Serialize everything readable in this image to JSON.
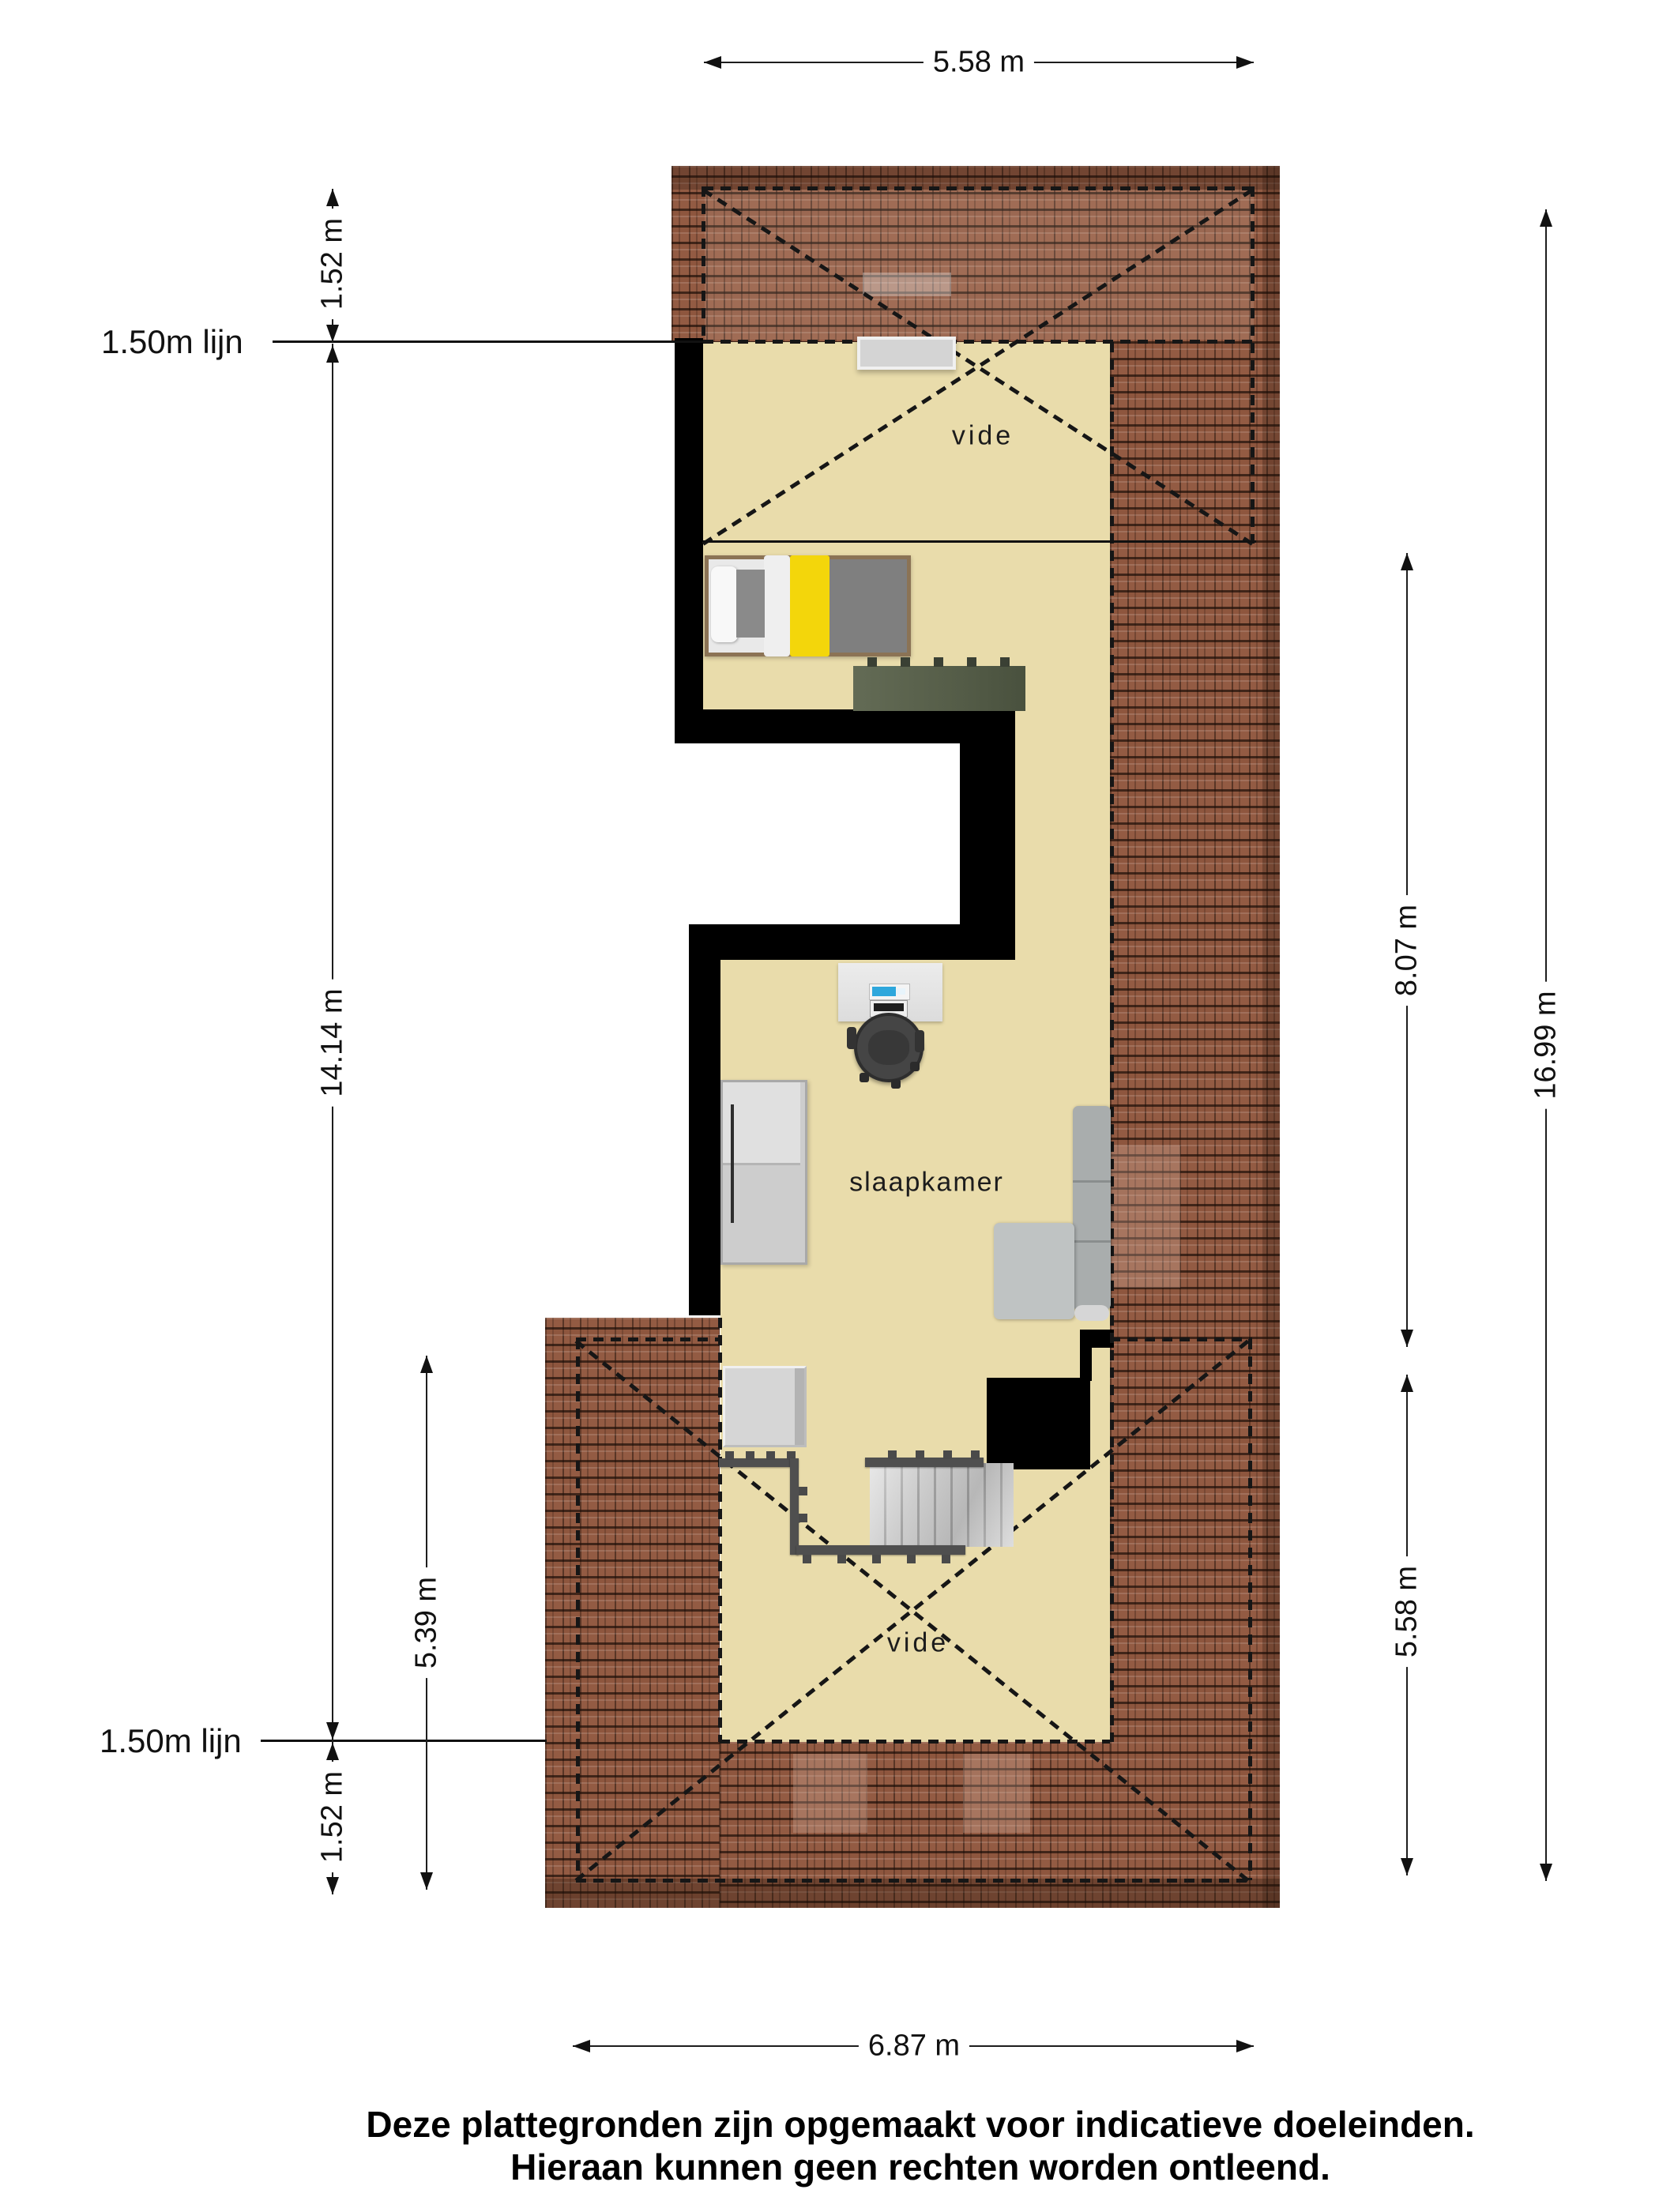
{
  "page": {
    "title": "Plattegrond"
  },
  "dimensions": {
    "top_width": "5.58 m",
    "left_top_offset": "1.52 m",
    "left_line_label_top": "1.50m lijn",
    "left_height_total": "14.14 m",
    "left_lower_height": "5.39 m",
    "left_line_label_bottom": "1.50m lijn",
    "left_bottom_offset": "1.52 m",
    "right_room_height": "8.07 m",
    "right_total_height": "16.99 m",
    "right_lower_height": "5.58 m",
    "bottom_width": "6.87 m"
  },
  "rooms": {
    "vide_top": "vide",
    "bedroom": "slaapkamer",
    "vide_bottom": "vide"
  },
  "footer": {
    "line1": "Deze plattegronden zijn opgemaakt voor indicatieve doeleinden.",
    "line2": "Hieraan kunnen geen rechten worden ontleend."
  },
  "colors": {
    "floor": "#e9dcab",
    "roof": "#935b43",
    "wall": "#000000",
    "bed_accent": "#f3d60b",
    "monitor_screen": "#2ea7dc"
  }
}
